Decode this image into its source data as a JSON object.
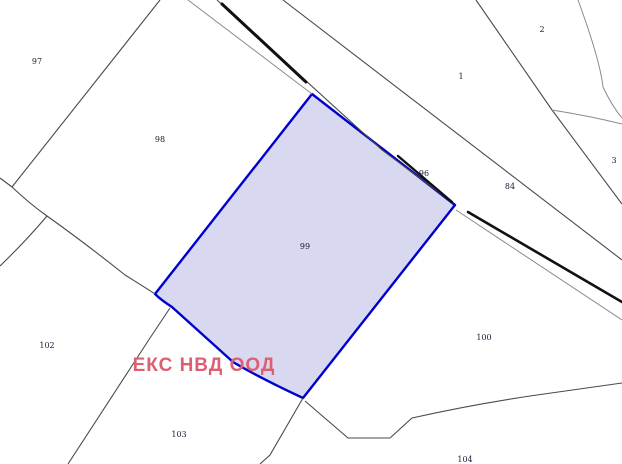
{
  "map": {
    "type": "cadastral-parcel-map",
    "selected_parcel": "99",
    "watermark": {
      "text": "ЕКС НВД ООД",
      "x": 204,
      "y": 366
    },
    "parcel_labels": [
      {
        "id": "97",
        "x": 37,
        "y": 62
      },
      {
        "id": "98",
        "x": 160,
        "y": 140
      },
      {
        "id": "99",
        "x": 305,
        "y": 247
      },
      {
        "id": "96",
        "x": 424,
        "y": 174
      },
      {
        "id": "84",
        "x": 510,
        "y": 187
      },
      {
        "id": "1",
        "x": 461,
        "y": 77
      },
      {
        "id": "2",
        "x": 542,
        "y": 30
      },
      {
        "id": "3",
        "x": 614,
        "y": 161
      },
      {
        "id": "100",
        "x": 484,
        "y": 338
      },
      {
        "id": "102",
        "x": 47,
        "y": 346
      },
      {
        "id": "103",
        "x": 179,
        "y": 435
      },
      {
        "id": "104",
        "x": 465,
        "y": 460
      }
    ]
  },
  "colors": {
    "selected_parcel_stroke": "#0000cc",
    "selected_parcel_fill": "rgba(125,125,205,0.30)",
    "boundary_color": "#4a4a4a",
    "road_color": "#111111",
    "watermark_color": "#dd5f72",
    "background": "#ffffff"
  }
}
